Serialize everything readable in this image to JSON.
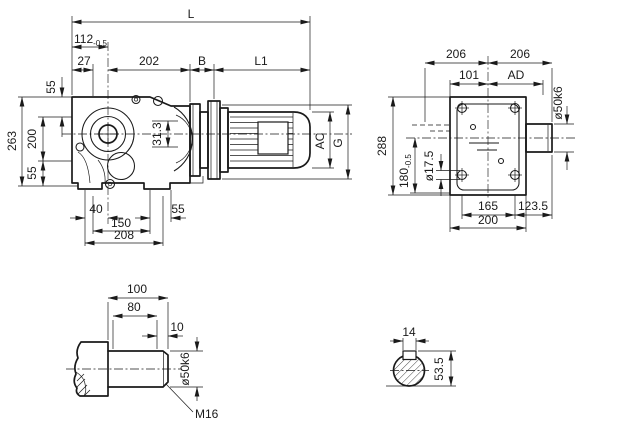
{
  "drawing": {
    "type": "gear-reducer-dimensional-drawing",
    "colors": {
      "line": "#1a1a1a",
      "background": "#ffffff"
    }
  },
  "labels": {
    "L": "L",
    "d112": "112",
    "d112_tol": "-0.5",
    "d27": "27",
    "d202": "202",
    "B": "B",
    "L1": "L1",
    "d55_top": "55",
    "d263": "263",
    "d200_side": "200",
    "d55_low": "55",
    "d31_3": "31.3",
    "d40": "40",
    "d150": "150",
    "d208": "208",
    "d55_foot": "55",
    "AC": "AC",
    "G": "G",
    "d206_l": "206",
    "d206_r": "206",
    "d101": "101",
    "AD": "AD",
    "d288": "288",
    "d180": "180",
    "d180_tol": "-0.5",
    "d17_5": "ø17.5",
    "d50k6_front": "ø50k6",
    "d165": "165",
    "d123_5": "123.5",
    "d200_front": "200",
    "d100": "100",
    "d80": "80",
    "d10": "10",
    "d50k6_shaft": "ø50k6",
    "M16": "M16",
    "d14": "14",
    "d53_5": "53.5"
  }
}
